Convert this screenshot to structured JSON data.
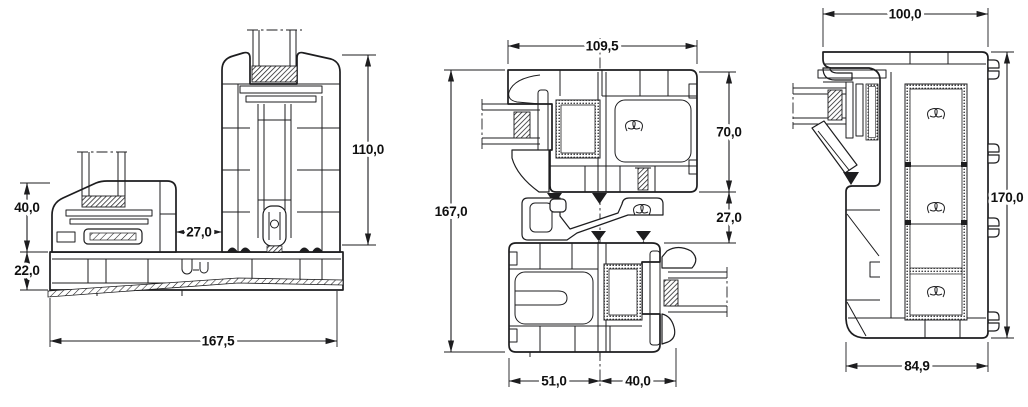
{
  "colors": {
    "line": "#1d1d1f",
    "text": "#101010",
    "background": "#ffffff"
  },
  "drawings": {
    "sill": {
      "dimensions": {
        "sash_rail_height": "40,0",
        "track_height": "22,0",
        "gap_width": "27,0",
        "panel_rail_height": "110,0",
        "overall_width": "167,5"
      }
    },
    "interlock": {
      "dimensions": {
        "overall_width": "109,5",
        "overall_height": "167,0",
        "upper_profile_depth": "70,0",
        "coupling_gap": "27,0",
        "lower_left_width": "51,0",
        "lower_right_width": "40,0"
      }
    },
    "jamb": {
      "dimensions": {
        "top_width": "100,0",
        "overall_height": "170,0",
        "bottom_width": "84,9"
      }
    }
  }
}
